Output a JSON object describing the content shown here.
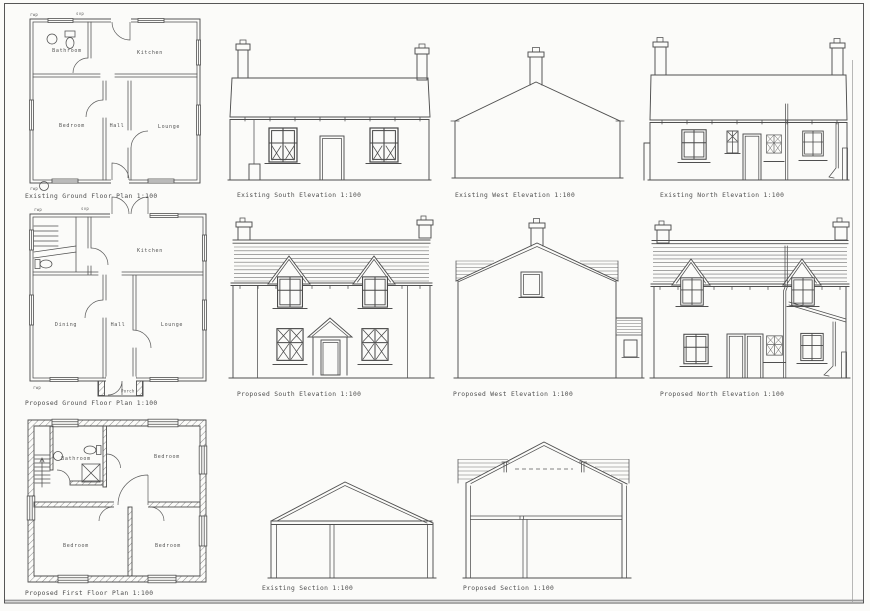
{
  "sheet": {
    "type": "architectural-drawing-sheet",
    "scale_note": "1:100"
  },
  "colors": {
    "paper": "#fbfbf9",
    "line": "#4f4f4f",
    "slate_line": "#707070",
    "text": "#4d4d4d"
  },
  "captions": {
    "existing_ground_floor_plan": "Existing Ground Floor Plan 1:100",
    "existing_south_elevation": "Existing South Elevation 1:100",
    "existing_west_elevation": "Existing West Elevation 1:100",
    "existing_north_elevation": "Existing North Elevation 1:100",
    "proposed_ground_floor_plan": "Proposed Ground Floor Plan 1:100",
    "proposed_south_elevation": "Proposed South Elevation 1:100",
    "proposed_west_elevation": "Proposed West Elevation 1:100",
    "proposed_north_elevation": "Proposed North Elevation 1:100",
    "proposed_first_floor_plan": "Proposed First Floor Plan 1:100",
    "existing_section": "Existing Section 1:100",
    "proposed_section": "Proposed Section 1:100"
  },
  "room_labels": {
    "existing_ground": {
      "bathroom": "Bathroom",
      "kitchen": "Kitchen",
      "bedroom": "Bedroom",
      "hall": "Hall",
      "lounge": "Lounge"
    },
    "proposed_ground": {
      "kitchen": "Kitchen",
      "dining": "Dining",
      "hall": "Hall",
      "lounge": "Lounge",
      "porch": "Porch"
    },
    "proposed_first": {
      "bathroom": "Bathroom",
      "bedroom_top": "Bedroom",
      "bedroom_left": "Bedroom",
      "bedroom_right": "Bedroom"
    }
  },
  "annotations": {
    "rwp": "rwp",
    "svp": "svp"
  }
}
